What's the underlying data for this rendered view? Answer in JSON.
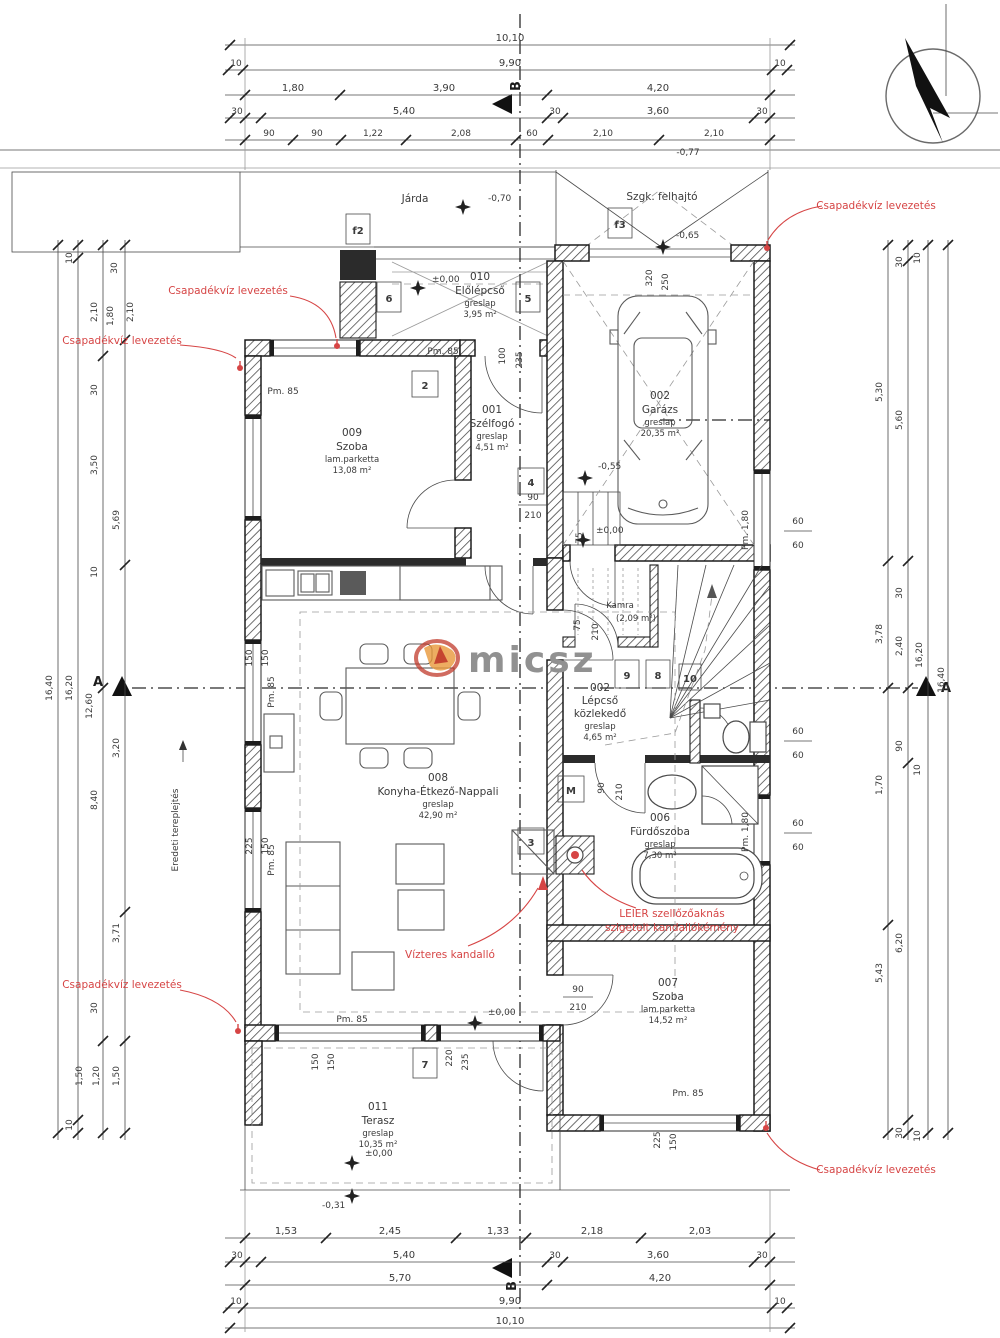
{
  "watermark": "micsz",
  "colors": {
    "annotation_red": "#d64545",
    "line_black": "#2b2b2b",
    "watermark_gray": "#919191",
    "logo_red": "#c0392b",
    "logo_orange": "#e8973a"
  },
  "red_notes": {
    "csapadek": "Csapadékvíz levezetés",
    "vizteres": "Vízteres kandalló",
    "leier_1": "LEIER szellőzőaknás",
    "leier_2": "szigetelt kandallókémény"
  },
  "site": {
    "jarda": "Járda",
    "felhajto": "Szgk. felhajtó",
    "terep": "Eredeti tereplejtés"
  },
  "levels": {
    "zero": "±0,00",
    "m031": "-0,31",
    "m055": "-0,55",
    "m065": "-0,65",
    "m070": "-0,70",
    "m077": "-0,77"
  },
  "sections": {
    "a": "A",
    "b": "B"
  },
  "parapets": {
    "pm85": "Pm. 85",
    "pm180": "Pm. 1,80"
  },
  "rooms": {
    "szoba009": {
      "num": "009",
      "name": "Szoba",
      "floor": "lam.parketta",
      "area": "13,08 m²"
    },
    "szelfogo": {
      "num": "001",
      "name": "Szélfogó",
      "floor": "greslap",
      "area": "4,51 m²"
    },
    "elolepcso": {
      "num": "010",
      "name": "Előlépcső",
      "floor": "greslap",
      "area": "3,95 m²"
    },
    "garazs": {
      "num": "002",
      "name": "Garázs",
      "floor": "greslap",
      "area": "20,35 m²"
    },
    "nappali": {
      "num": "008",
      "name": "Konyha-Étkező-Nappali",
      "floor": "greslap",
      "area": "42,90 m²"
    },
    "lepcso": {
      "num": "002",
      "name": "Lépcső",
      "name2": "közlekedő",
      "floor": "greslap",
      "area": "4,65 m²"
    },
    "kamra": {
      "name": "Kamra",
      "area": "(2,09 m²)"
    },
    "furdo": {
      "num": "006",
      "name": "Fürdőszoba",
      "floor": "greslap",
      "area": "7,30 m²"
    },
    "szoba007": {
      "num": "007",
      "name": "Szoba",
      "floor": "lam.parketta",
      "area": "14,52 m²"
    },
    "terasz": {
      "num": "011",
      "name": "Terasz",
      "floor": "greslap",
      "area": "10,35 m²"
    }
  },
  "openings": {
    "f2": "f2",
    "f3": "f3",
    "n2": "2",
    "n3": "3",
    "n4": "4",
    "n5": "5",
    "n6": "6",
    "n7": "7",
    "n8": "8",
    "n9": "9",
    "n10": "10",
    "m": "M"
  },
  "dims": {
    "d10": "10",
    "d30": "30",
    "d60": "60",
    "d75": "75",
    "d90": "90",
    "d100": "100",
    "d150": "150",
    "d210": "210",
    "d220": "220",
    "d225": "225",
    "d235": "235",
    "d250": "250",
    "d320": "320",
    "m1010": "10,10",
    "m990": "9,90",
    "m180": "1,80",
    "m390": "3,90",
    "m420": "4,20",
    "m540": "5,40",
    "m360": "3,60",
    "m122": "1,22",
    "m208": "2,08",
    "m210": "2,10",
    "m153": "1,53",
    "m245": "2,45",
    "m133": "1,33",
    "m218": "2,18",
    "m203": "2,03",
    "m570": "5,70",
    "m350": "3,50",
    "m569": "5,69",
    "m1640": "16,40",
    "m1620": "16,20",
    "m1260": "12,60",
    "m320": "3,20",
    "m840": "8,40",
    "m371": "3,71",
    "m150": "1,50",
    "m120": "1,20",
    "m530": "5,30",
    "m560": "5,60",
    "m378": "3,78",
    "m240": "2,40",
    "m170": "1,70",
    "m620": "6,20",
    "m543": "5,43"
  }
}
